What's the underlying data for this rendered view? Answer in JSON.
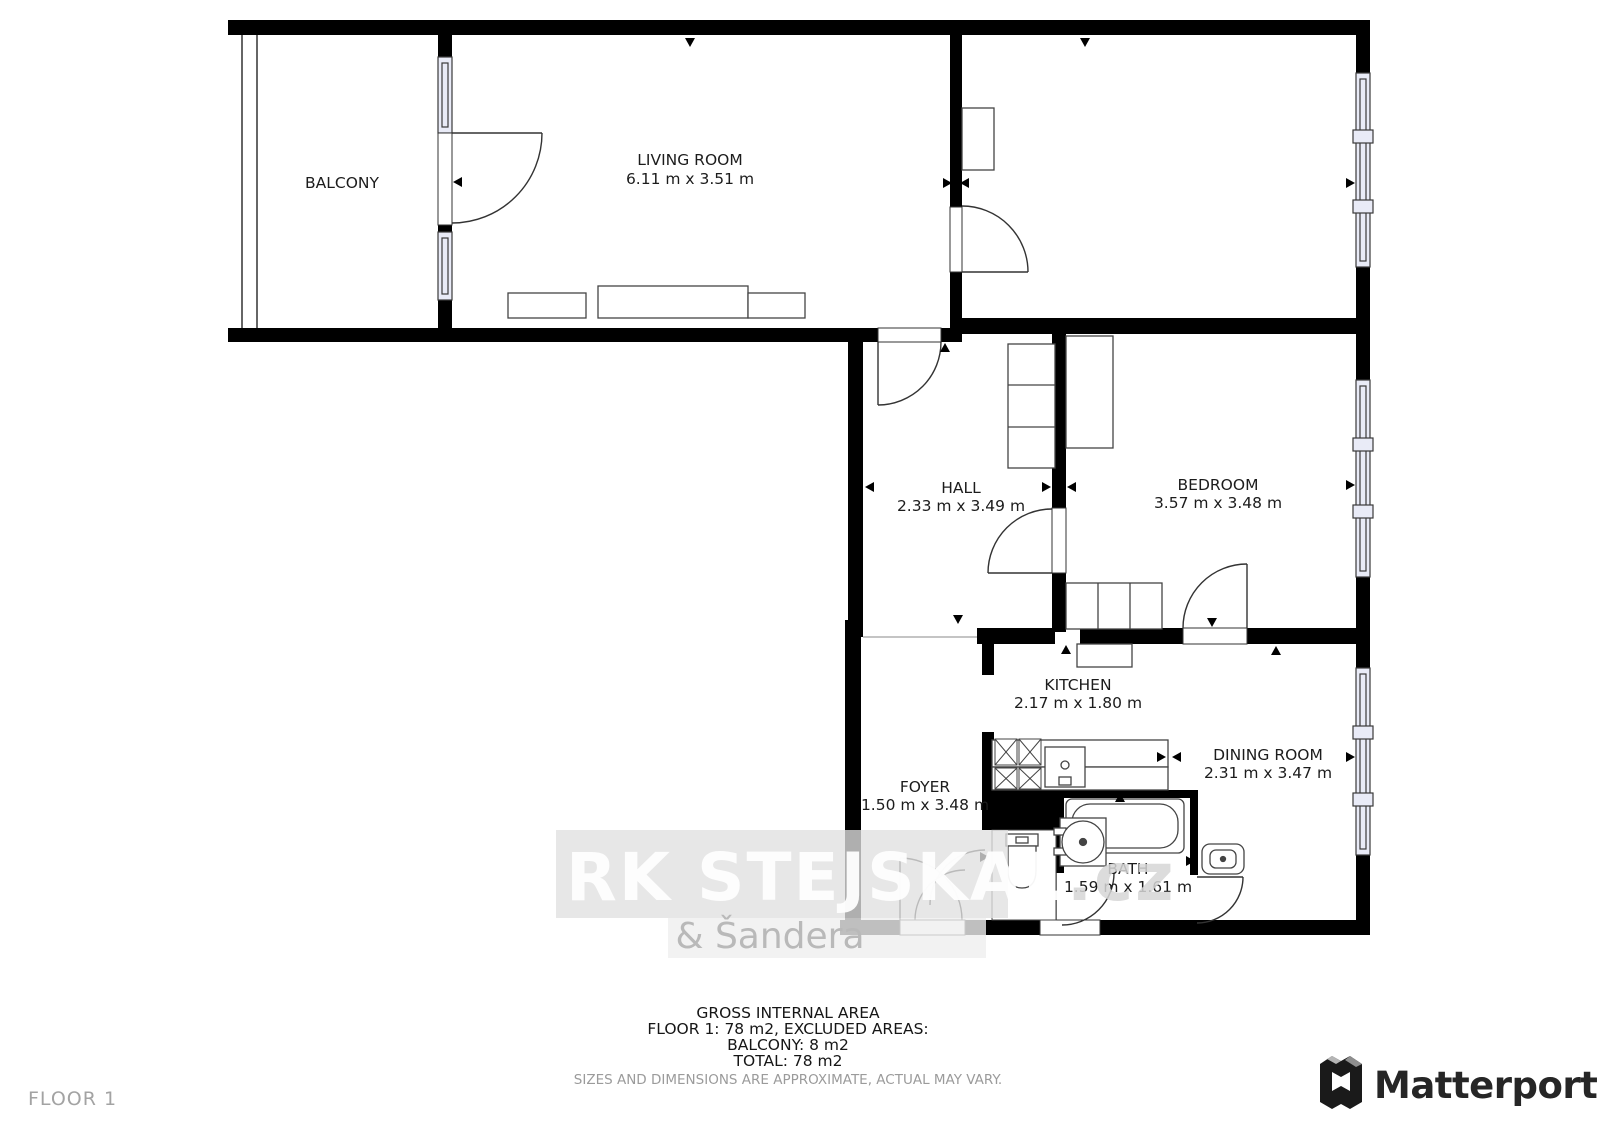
{
  "plan": {
    "rooms": [
      {
        "name": "BALCONY",
        "dims": ""
      },
      {
        "name": "LIVING ROOM",
        "dims": "6.11 m x 3.51 m"
      },
      {
        "name": "HALL",
        "dims": "2.33 m x 3.49 m"
      },
      {
        "name": "BEDROOM",
        "dims": "3.57 m x 3.48 m"
      },
      {
        "name": "KITCHEN",
        "dims": "2.17 m x 1.80 m"
      },
      {
        "name": "DINING ROOM",
        "dims": "2.31 m x 3.47 m"
      },
      {
        "name": "FOYER",
        "dims": "1.50 m x 3.48 m"
      },
      {
        "name": "BATH",
        "dims": "1.59 m x 1.61 m"
      }
    ]
  },
  "watermark": {
    "primary": "RK STEJSKAL",
    "suffix": ".cz",
    "secondary": "& Šandera"
  },
  "footer": {
    "line1": "GROSS INTERNAL AREA",
    "line2": "FLOOR 1: 78 m2, EXCLUDED AREAS:",
    "line3": "BALCONY: 8 m2",
    "line4": "TOTAL: 78 m2",
    "disclaimer": "SIZES AND DIMENSIONS ARE APPROXIMATE, ACTUAL MAY VARY."
  },
  "floor_label": "FLOOR 1",
  "branding": {
    "logo_text": "Matterport"
  },
  "colors": {
    "wall": "#000000",
    "window_fill": "#e9ebf7",
    "watermark_band": "#e0e0e0",
    "watermark_text": "#ffffff",
    "footer_muted": "#9b9b9b"
  }
}
